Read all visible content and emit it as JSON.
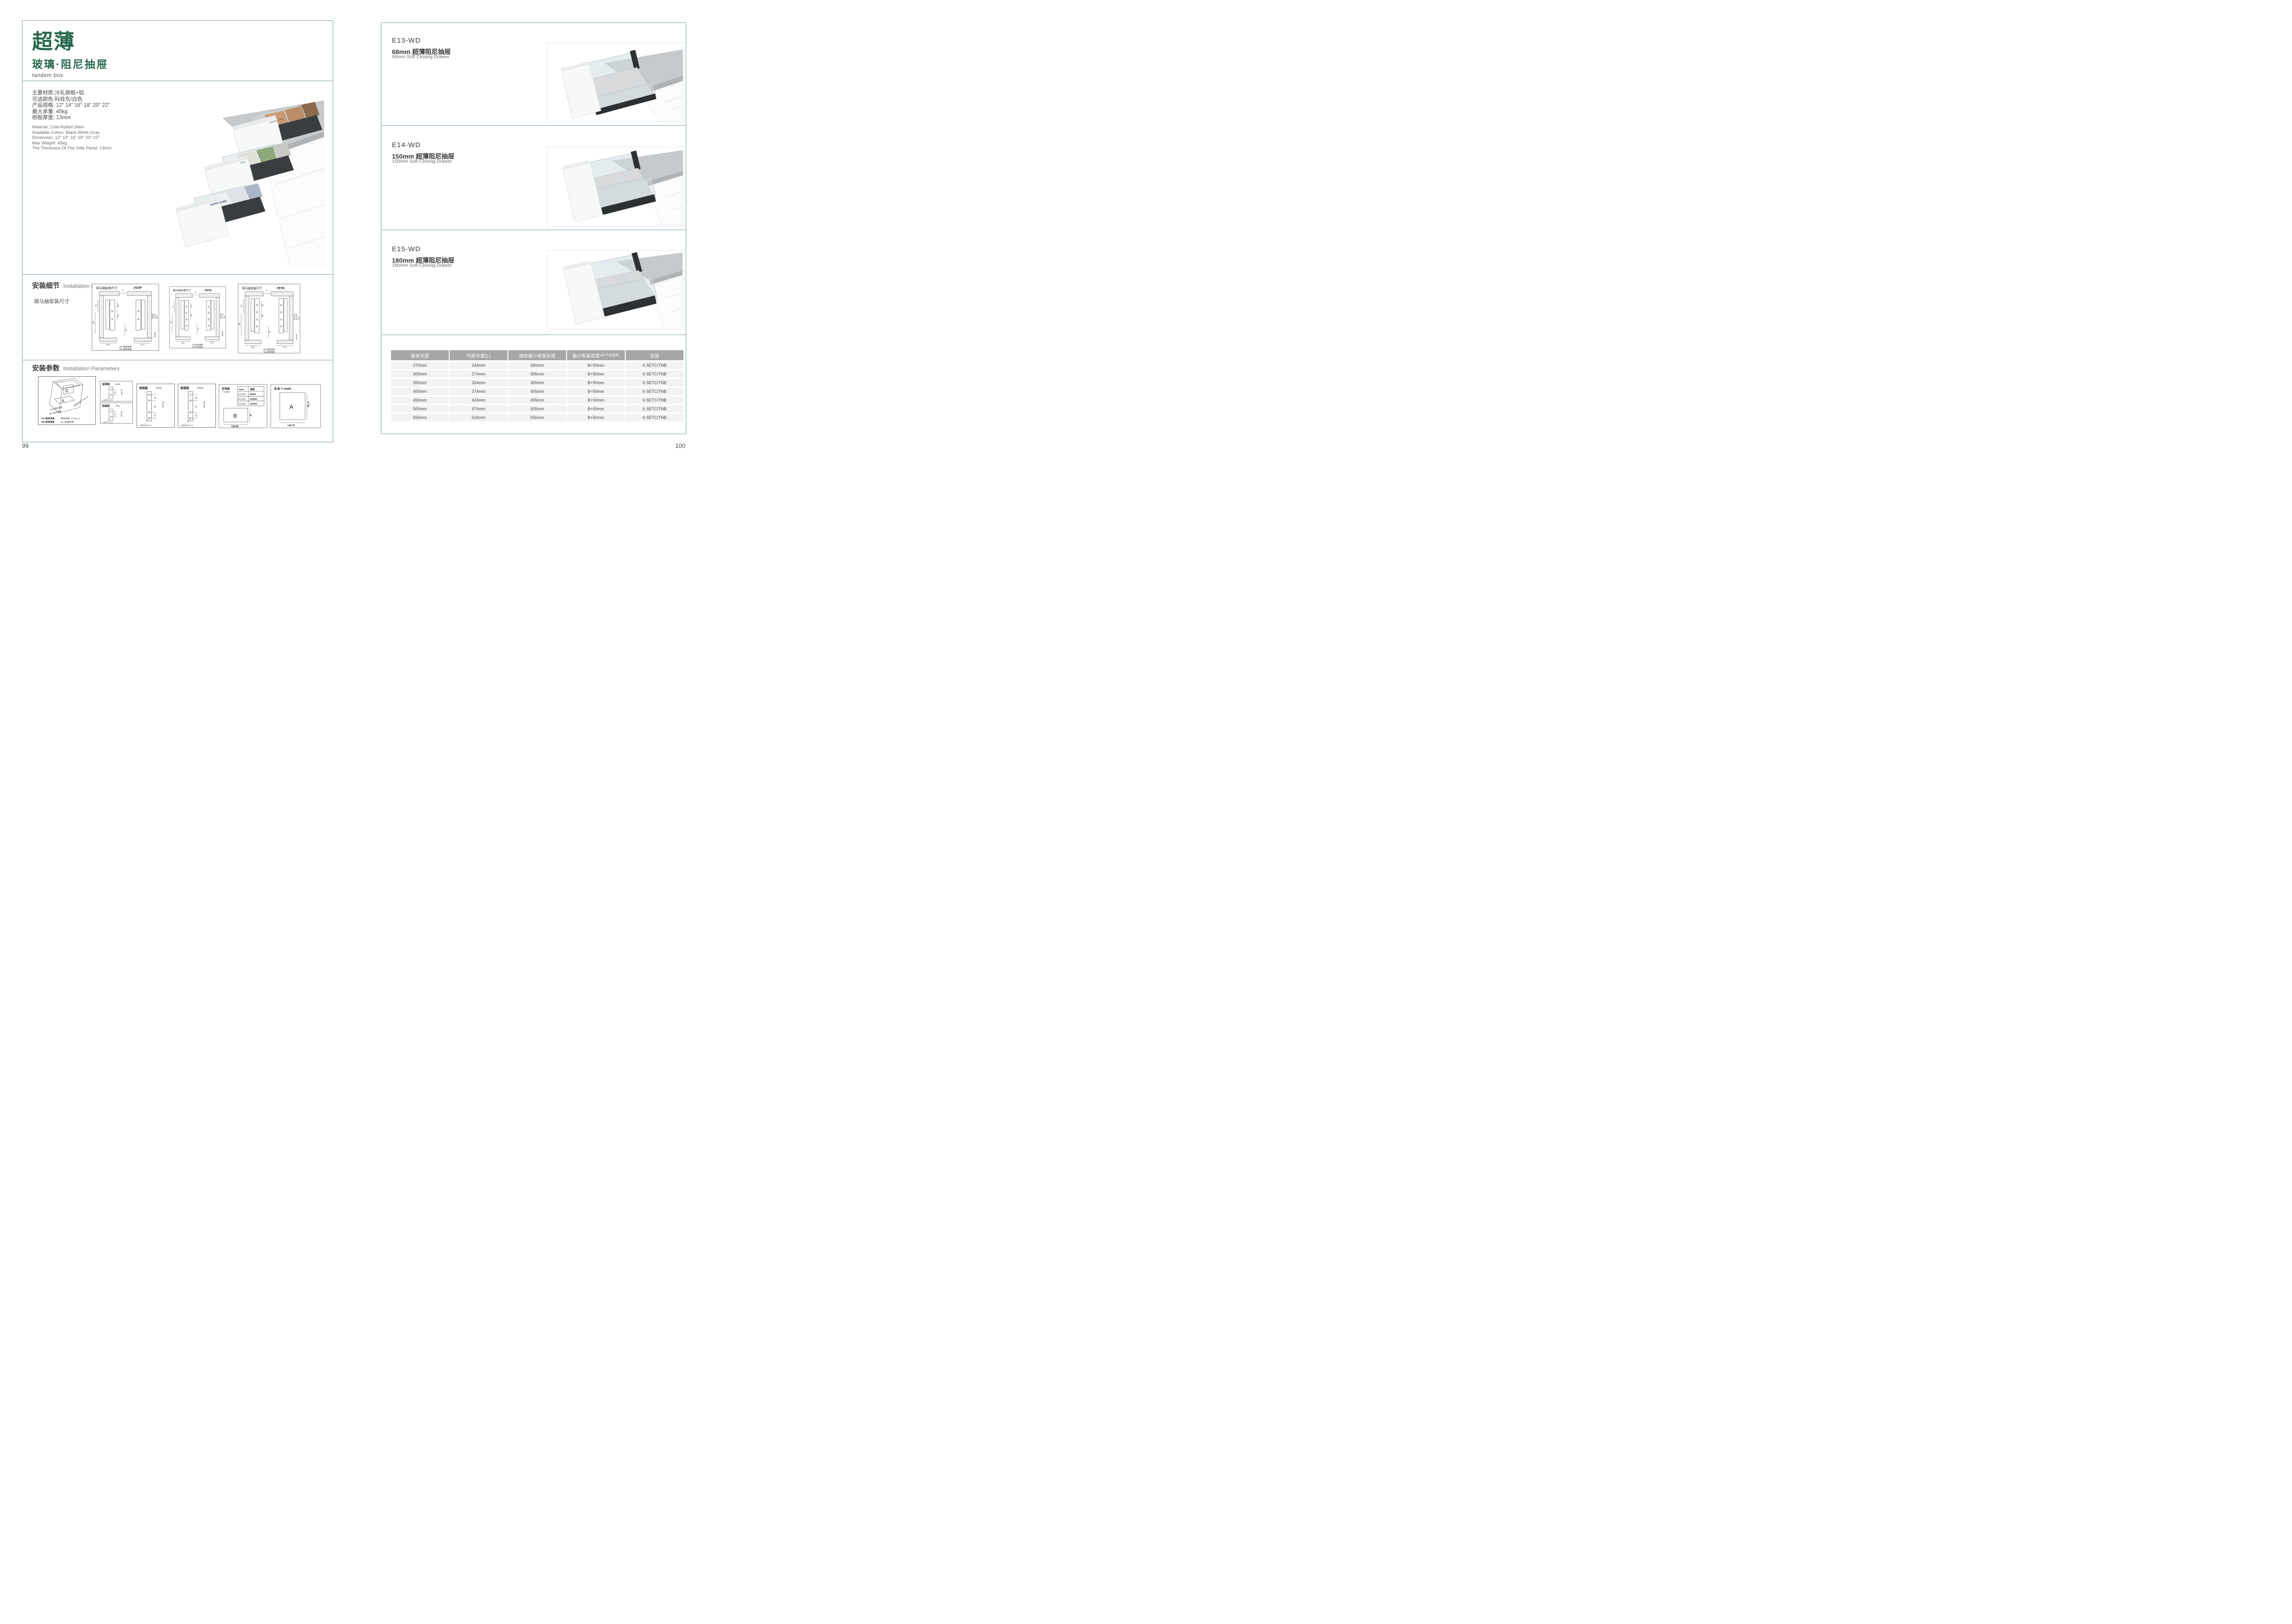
{
  "colors": {
    "accent_green": "#26684a",
    "border_green": "#76a292",
    "table_header_bg": "#a7a7aa",
    "table_row_bg": "#f3f3f5"
  },
  "left_page": {
    "page_number": "99",
    "title": "超薄",
    "subtitle": "玻璃·阻尼抽屉",
    "tagline": "tandem box",
    "specs_cn": [
      "主要材质:冷轧钢板+铝",
      "可选颜色:科技灰/白色",
      "产品规格: 12\" 14\" 16\" 18\" 20\" 22\"",
      "最大承重: 45kg",
      "侧板厚度; 13mm"
    ],
    "specs_en": [
      "Material: Cold-Rolled Steel",
      "Available Colors: Black,White,Gray",
      "Dimension: 12\" 14\" 16\" 18\" 20\" 22\"",
      "Max Weight: 45kg",
      "The Thickness Of The Side Panel: 13mm"
    ],
    "product_image": {
      "box_top": "BINGO HIPIE",
      "box_mid": "EDO",
      "box_bottom": "SUPER CORN"
    },
    "install_details": {
      "title_cn": "安装细节",
      "title_en": "Installation Details",
      "subtitle": "骑马抽安装尺寸",
      "diagrams": [
        {
          "title": "骑马抽安装尺寸",
          "code": "-707P",
          "dims": {
            "top": "9",
            "a": "20",
            "b": "32",
            "center": "16",
            "left_a": "32",
            "left_b": "54",
            "bottom_a": "16.5",
            "bottom_b": "37.5"
          },
          "right_dims": [
            "Min82",
            "91.50",
            "113",
            "Min36"
          ],
          "lw": "LW=柜体净宽",
          "kb": "KB=柜体宽度"
        },
        {
          "title": "骑马抽安装尺寸",
          "code": "-707G",
          "dims": {
            "top": "9",
            "a": "20",
            "b": "32",
            "center": "16",
            "left_a": "32",
            "left_b": "54",
            "bottom_a": "16.5",
            "bottom_b": "37.5"
          },
          "right_dims": [
            "Min162",
            "171.50",
            "195",
            "Min36"
          ],
          "lw": "LW=柜体净宽",
          "kb": "KB=柜体宽度"
        },
        {
          "title": "骑马抽安装尺寸",
          "code": "-707H",
          "dims": {
            "top": "9",
            "a": "20",
            "b": "32",
            "center": "16",
            "left_a": "32",
            "left_b": "54",
            "bottom_a": "16.5",
            "bottom_b": "37.5"
          },
          "right_dims": [
            "Min192",
            "201.50",
            "225",
            "Min36"
          ],
          "lw": "LW=柜体净宽",
          "kb": "KB=柜体宽度"
        }
      ]
    },
    "install_params": {
      "title_cn": "安装参数",
      "title_en": "Installation Parameters",
      "iso": {
        "letter_a": "A",
        "letter_b": "B",
        "lw": "LW=柜体净宽",
        "kb": "KB=柜体宽度",
        "lt": "柜体内空LT=NL+3",
        "legend1": "LW=柜体净宽",
        "legend2": "柜体内空: LT=NL+3",
        "legend3": "KB=柜体宽度",
        "legend4": "NL=标准长度"
      },
      "front_panels": [
        {
          "title": "前面板",
          "code": "-707P",
          "dim": "32",
          "min": "min 54",
          "holes": "2-Ø2+0.2-0.1"
        },
        {
          "title": "前面板",
          "code": "-707L",
          "dim": "32",
          "min": "min 54",
          "holes": "2-Ø2+0.2-0.1"
        },
        {
          "title": "前面板",
          "code": "-707G",
          "dim_a": "32",
          "dim_b": "64",
          "dim_c": "32",
          "min": "min 54",
          "holes": "4-Ø2+0.2-0.1"
        },
        {
          "title": "前面板",
          "code": "-707H",
          "dim_a": "32",
          "dim_b": "64",
          "dim_c": "32",
          "min": "min 54",
          "holes": "4-Ø2+0.2-0.1"
        }
      ],
      "back_panel": {
        "title": "后背板",
        "thickness": "T=16MM",
        "spec_col1": "Spec.",
        "spec_col2": "高度",
        "spec_rows": [
          [
            "E13-WD",
            "68MM"
          ],
          [
            "E14-WD",
            "150MM"
          ],
          [
            "E15-WD",
            "180MM"
          ]
        ],
        "letter": "B",
        "height_label": "H",
        "width_label": "LW-85"
      },
      "bottom_panel": {
        "title": "底 板 T=16MM",
        "letter": "A",
        "side_label": "NL-6",
        "width_label": "LW-75"
      }
    }
  },
  "right_page": {
    "page_number": "100",
    "products": [
      {
        "code": "E13-WD",
        "name_cn": "68mm 超薄阻尼抽屉",
        "name_en": "68mm Soft Closing Drawer"
      },
      {
        "code": "E14-WD",
        "name_cn": "150mm 超薄阻尼抽屉",
        "name_en": "150mm Soft Closing Drawer"
      },
      {
        "code": "E15-WD",
        "name_cn": "180mm 超薄阻尼抽屉",
        "name_en": "180mm Soft Closing Drawer"
      }
    ],
    "table": {
      "headers": [
        "基本长度",
        "内部长度(L)",
        "抽屉最小安装长度",
        "最小安装高度",
        "包装"
      ],
      "header4_suffix": "(B=产品高度)",
      "rows": [
        [
          "270mm",
          "244mm",
          "280mm",
          "B+50mm",
          "6 SETC/TNB"
        ],
        [
          "300mm",
          "274mm",
          "305mm",
          "B+50mm",
          "6 SETC/TNB"
        ],
        [
          "350mm",
          "324mm",
          "355mm",
          "B+50mm",
          "6 SETC/TNB"
        ],
        [
          "400mm",
          "374mm",
          "405mm",
          "B+50mm",
          "6 SETC/TNB"
        ],
        [
          "450mm",
          "424mm",
          "455mm",
          "B+50mm",
          "6 SETC/TNB"
        ],
        [
          "500mm",
          "474mm",
          "505mm",
          "B+50mm",
          "6 SETC/TNB"
        ],
        [
          "550mm",
          "524mm",
          "555mm",
          "B+50mm",
          "6 SETC/TNB"
        ]
      ]
    }
  }
}
